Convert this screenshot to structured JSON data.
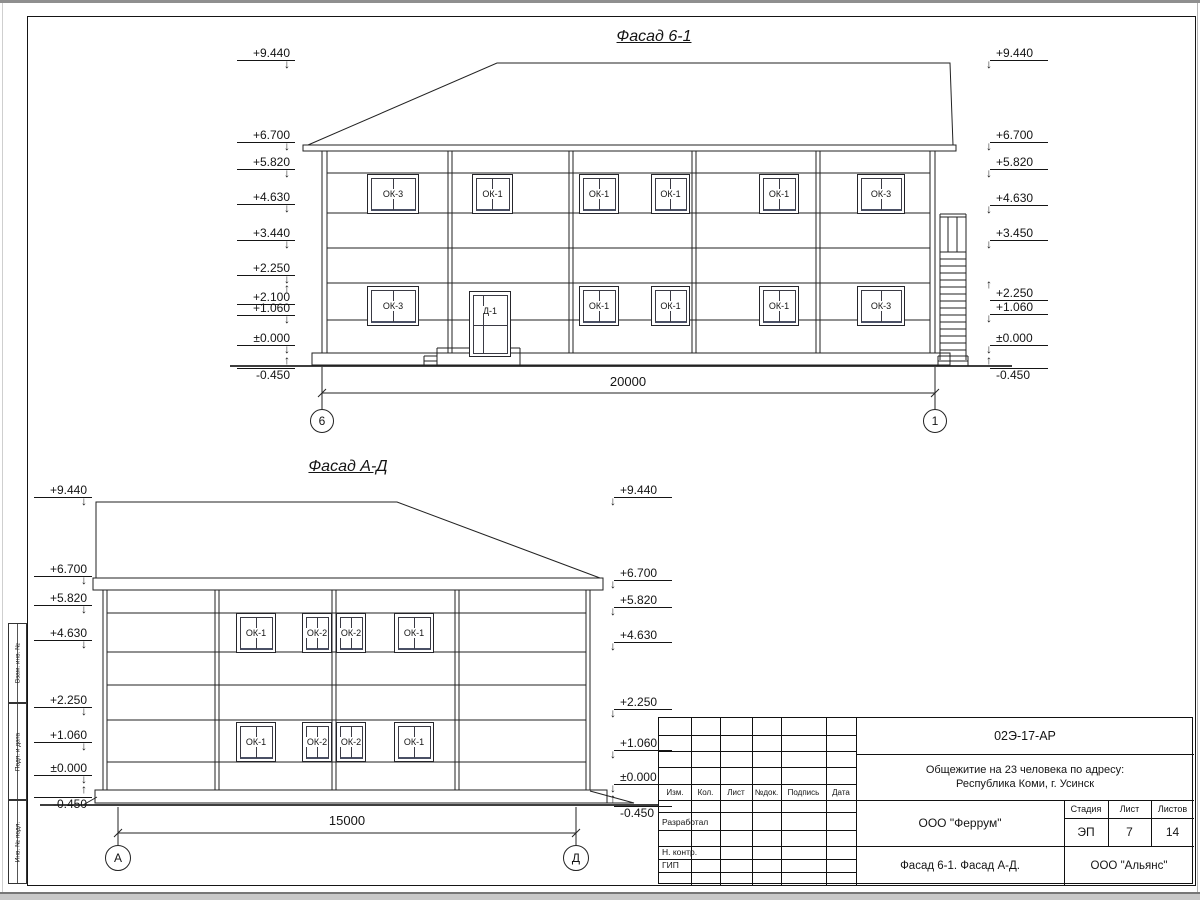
{
  "sheet": {
    "side_stamp": [
      "Взам. инв. №",
      "Подп. и дата",
      "Инв. № подл."
    ],
    "title_block": {
      "code": "02Э-17-АР",
      "object_line1": "Общежитие на 23 человека по адресу:",
      "object_line2": "Республика Коми, г. Усинск",
      "designer_org": "ООО \"Феррум\"",
      "stage_label": "Стадия",
      "stage": "ЭП",
      "sheet_label": "Лист",
      "sheet_no": "7",
      "sheets_label": "Листов",
      "sheets_total": "14",
      "content": "Фасад 6-1. Фасад  А-Д.",
      "client_org": "ООО \"Альянс\"",
      "columns": [
        "Изм.",
        "Кол.",
        "Лист",
        "№док.",
        "Подпись",
        "Дата"
      ],
      "rows": [
        "Разработал",
        "Н. контр.",
        "ГИП"
      ]
    }
  },
  "facade1": {
    "title": "Фасад 6-1",
    "marks_left": [
      "+9.440",
      "+6.700",
      "+5.820",
      "+4.630",
      "+3.440",
      "+2.250",
      "+2.100",
      "+1.060",
      "±0.000",
      "-0.450"
    ],
    "marks_right": [
      "+9.440",
      "+6.700",
      "+5.820",
      "+4.630",
      "+3.450",
      "+2.250",
      "+1.060",
      "±0.000",
      "-0.450"
    ],
    "windows_floor2": [
      "ОК-3",
      "ОК-1",
      "ОК-1",
      "ОК-1",
      "ОК-1",
      "ОК-3"
    ],
    "windows_floor1": [
      "ОК-3",
      "ОК-1",
      "ОК-1",
      "ОК-1",
      "ОК-3"
    ],
    "door": "Д-1",
    "dimension": "20000",
    "axis_left": "6",
    "axis_right": "1"
  },
  "facade2": {
    "title": "Фасад А-Д",
    "marks_left": [
      "+9.440",
      "+6.700",
      "+5.820",
      "+4.630",
      "+2.250",
      "+1.060",
      "±0.000",
      "-0.450"
    ],
    "marks_right": [
      "+9.440",
      "+6.700",
      "+5.820",
      "+4.630",
      "+2.250",
      "+1.060",
      "±0.000",
      "-0.450"
    ],
    "windows_floor2": [
      "ОК-1",
      "ОК-2",
      "ОК-2",
      "ОК-1"
    ],
    "windows_floor1": [
      "ОК-1",
      "ОК-2",
      "ОК-2",
      "ОК-1"
    ],
    "dimension": "15000",
    "axis_left": "А",
    "axis_right": "Д"
  }
}
